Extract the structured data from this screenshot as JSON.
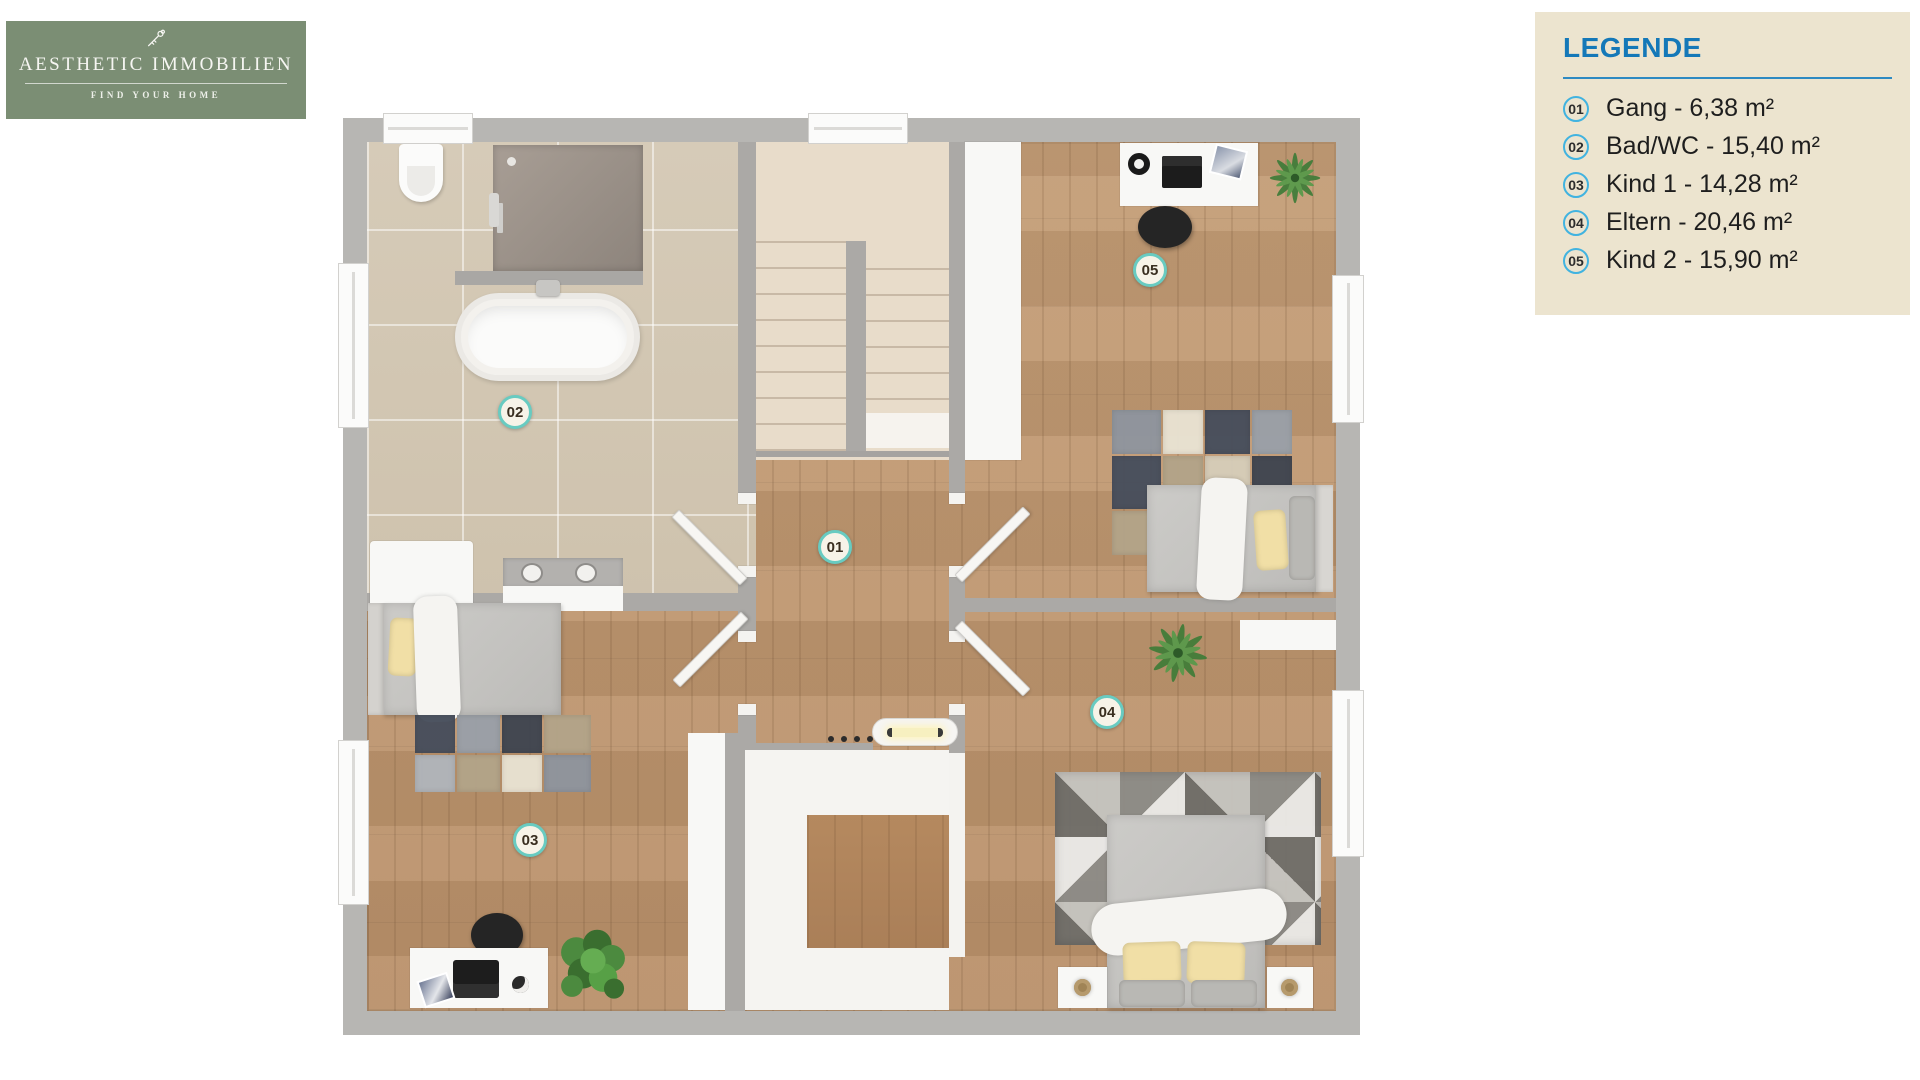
{
  "logo": {
    "title": "AESTHETIC IMMOBILIEN",
    "tagline": "FIND YOUR HOME",
    "bg_color": "#7b8e74"
  },
  "legend": {
    "title": "LEGENDE",
    "title_color": "#1478b8",
    "bg_color": "#ece4cf",
    "items": [
      {
        "number": "01",
        "label": "Gang - 6,38 m²"
      },
      {
        "number": "02",
        "label": "Bad/WC - 15,40 m²"
      },
      {
        "number": "03",
        "label": "Kind 1 - 14,28 m²"
      },
      {
        "number": "04",
        "label": "Eltern - 20,46 m²"
      },
      {
        "number": "05",
        "label": "Kind 2 - 15,90 m²"
      }
    ]
  },
  "floorplan": {
    "badges": [
      {
        "id": "01",
        "room": "Gang"
      },
      {
        "id": "02",
        "room": "Bad/WC"
      },
      {
        "id": "03",
        "room": "Kind 1"
      },
      {
        "id": "04",
        "room": "Eltern"
      },
      {
        "id": "05",
        "room": "Kind 2"
      }
    ],
    "colors": {
      "wall": "#aba9a6",
      "wood_floor": "#c09a73",
      "bathroom_tile": "#d4c9b6",
      "stairs": "#e8dcca",
      "badge_ring": "#68cbc1"
    }
  }
}
